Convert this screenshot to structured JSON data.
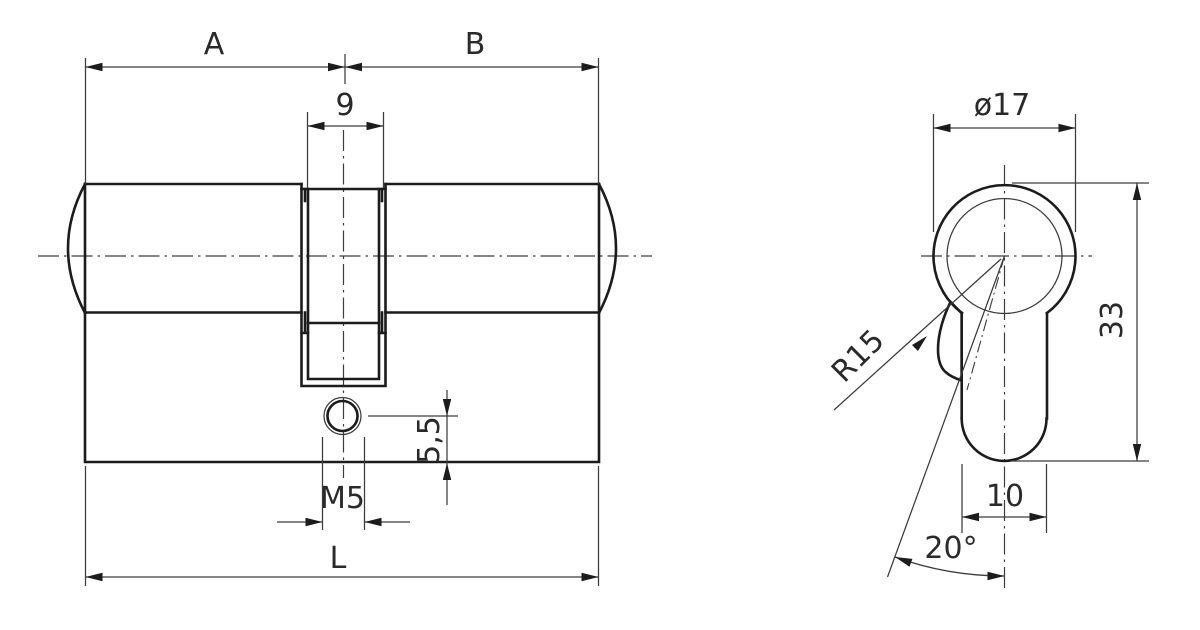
{
  "drawing": {
    "background_color": "#ffffff",
    "outline_color": "#1c1c1c",
    "dimension_line_color": "#3c3c3c",
    "front_view": {
      "dim_a_label": "A",
      "dim_b_label": "B",
      "dim_cam_width": "9",
      "dim_screw_center_to_bottom": "5,5",
      "dim_fixing_thread": "M5",
      "dim_total_length": "L"
    },
    "profile_view": {
      "dim_plug_diameter": "ø17",
      "dim_profile_height": "33",
      "dim_cam_radius": "R15",
      "dim_body_width": "10",
      "dim_cam_angle": "20°"
    }
  }
}
